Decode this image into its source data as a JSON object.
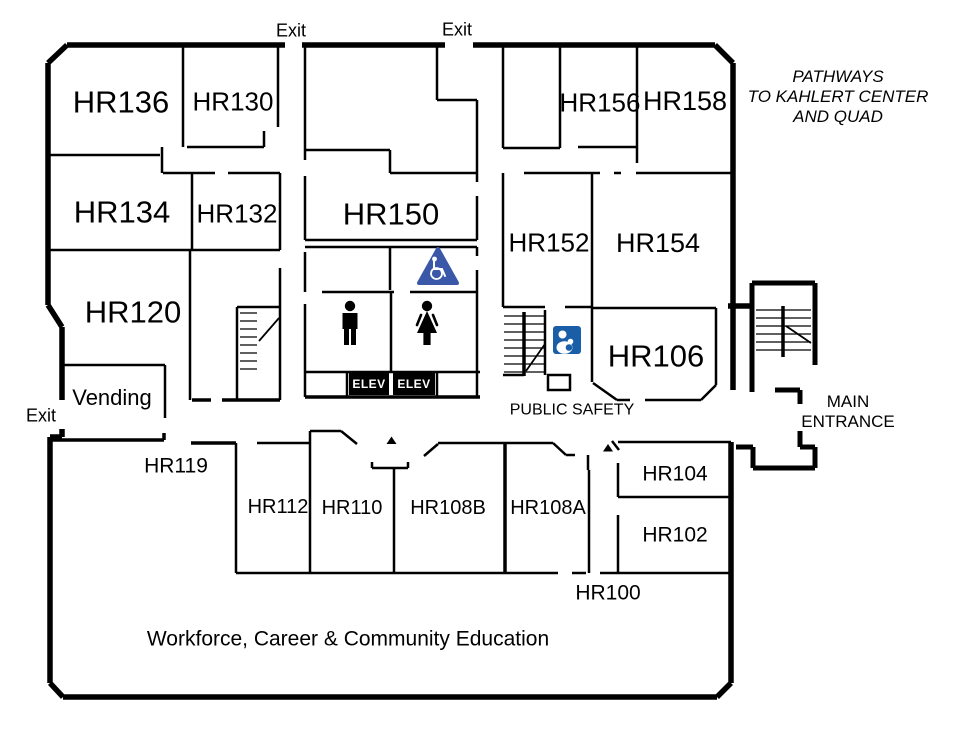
{
  "title": "Building floor plan",
  "department_banner": "Workforce, Career & Community Education",
  "rooms": {
    "hr136": "HR136",
    "hr130": "HR130",
    "hr134": "HR134",
    "hr132": "HR132",
    "hr120": "HR120",
    "hr150": "HR150",
    "hr152": "HR152",
    "hr154": "HR154",
    "hr156": "HR156",
    "hr158": "HR158",
    "hr106": "HR106",
    "hr119": "HR119",
    "hr112": "HR112",
    "hr110": "HR110",
    "hr108b": "HR108B",
    "hr108a": "HR108A",
    "hr104": "HR104",
    "hr102": "HR102",
    "hr100": "HR100",
    "vending": "Vending"
  },
  "labels": {
    "exit_top_left": "Exit",
    "exit_top_center": "Exit",
    "exit_left": "Exit",
    "public_safety": "PUBLIC SAFETY",
    "main_entrance_line1": "MAIN",
    "main_entrance_line2": "ENTRANCE",
    "pathways_line1": "PATHWAYS",
    "pathways_line2": "TO KAHLERT CENTER",
    "pathways_line3": "AND QUAD"
  },
  "elevators": {
    "left": "ELEV",
    "right": "ELEV"
  },
  "icons": {
    "accessible": "wheelchair-accessible",
    "male": "male-restroom",
    "female": "female-restroom",
    "safety": "public-safety",
    "stairs": "staircase"
  },
  "colors": {
    "walls": "#000000",
    "accessible_blue": "#3a57a8",
    "safety_blue": "#1b5ea8",
    "elevator_bg": "#000000",
    "elevator_text": "#ffffff"
  }
}
